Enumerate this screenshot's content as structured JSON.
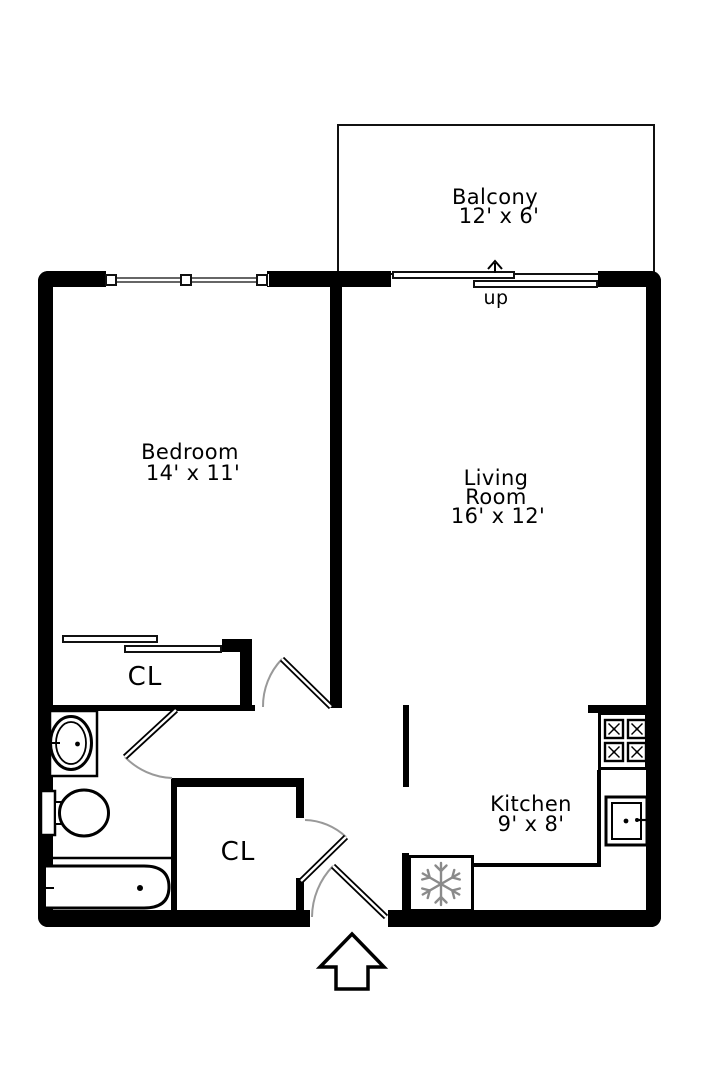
{
  "plan": {
    "balcony": {
      "name": "Balcony",
      "dims": "12' x 6'"
    },
    "bedroom": {
      "name": "Bedroom",
      "dims": "14' x 11'"
    },
    "living_room": {
      "line1": "Living",
      "line2": "Room",
      "dims": "16' x 12'"
    },
    "kitchen": {
      "name": "Kitchen",
      "dims": "9' x 8'"
    },
    "bedroom_closet": {
      "label": "CL"
    },
    "hall_closet": {
      "label": "CL"
    },
    "stairs": {
      "label": "up"
    },
    "colors": {
      "wall": "#000000",
      "door_swing_arc": "#999999",
      "appliance_icon": "#8a8a8a"
    }
  }
}
